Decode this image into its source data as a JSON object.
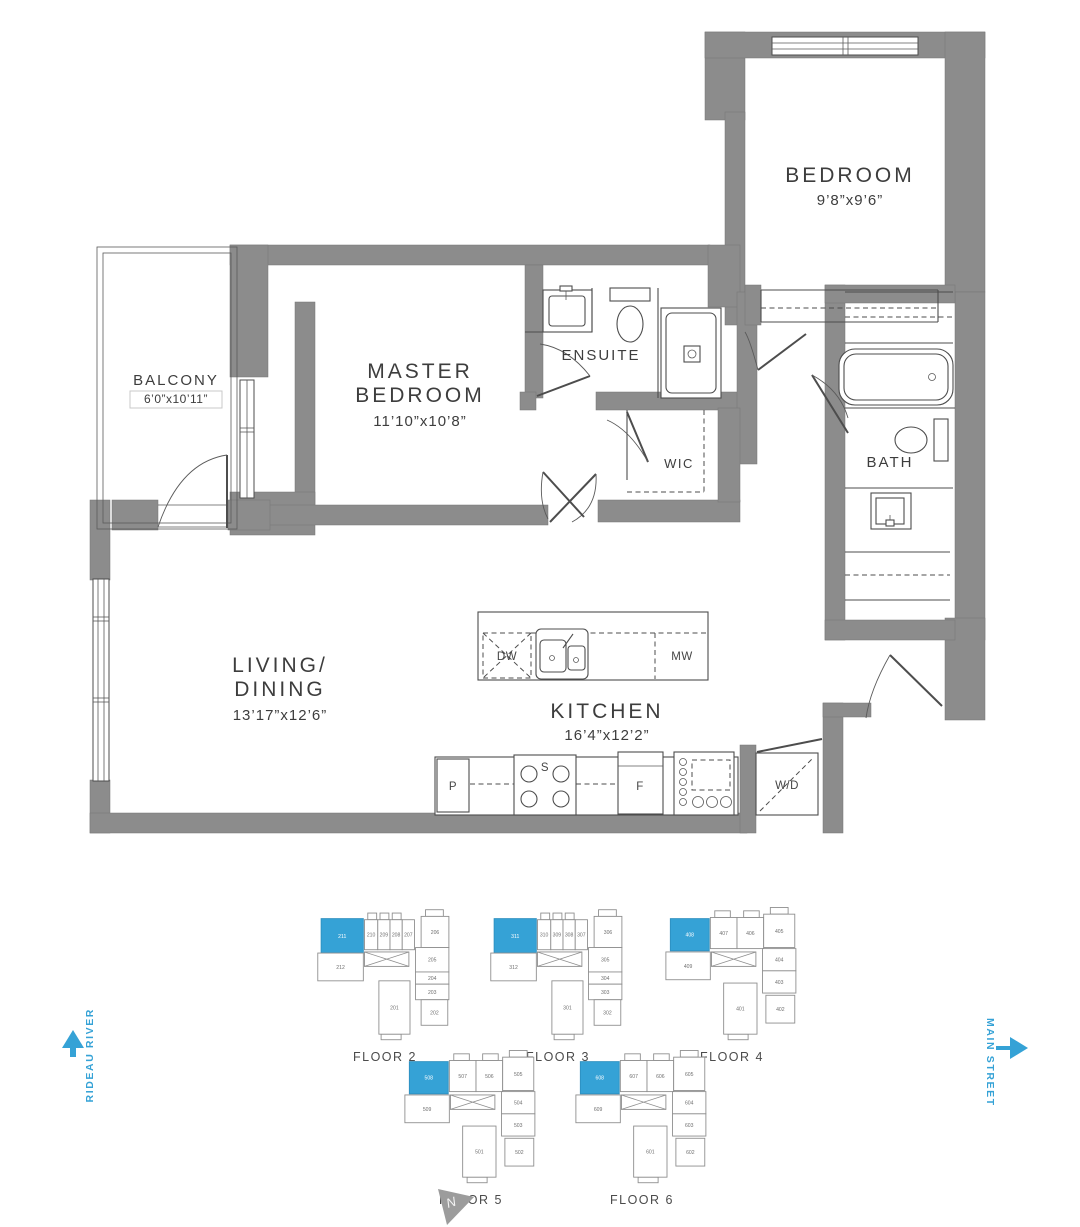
{
  "floorplan": {
    "rooms": {
      "bedroom": {
        "label": "BEDROOM",
        "dims": "9’8”x9’6”"
      },
      "master_bedroom": {
        "line1": "MASTER",
        "line2": "BEDROOM",
        "dims": "11’10”x10’8”"
      },
      "ensuite": {
        "label": "ENSUITE"
      },
      "wic": {
        "label": "WIC"
      },
      "bath": {
        "label": "BATH"
      },
      "balcony": {
        "label": "BALCONY",
        "dims": "6’0”x10’11”"
      },
      "living_dining": {
        "line1": "LIVING/",
        "line2": "DINING",
        "dims": "13’17”x12’6”"
      },
      "kitchen": {
        "label": "KITCHEN",
        "dims": "16’4”x12’2”"
      }
    },
    "appliances": {
      "dishwasher": "DW",
      "microwave": "MW",
      "pantry": "P",
      "stove": "S",
      "fridge": "F",
      "washer_dryer": "W/D"
    }
  },
  "keyplans": {
    "floors": [
      {
        "label": "FLOOR 2",
        "layout": "A",
        "highlighted": "211",
        "units": [
          "211",
          "210",
          "209",
          "208",
          "207",
          "206",
          "205",
          "204",
          "203",
          "202",
          "201",
          "212"
        ]
      },
      {
        "label": "FLOOR 3",
        "layout": "A",
        "highlighted": "311",
        "units": [
          "311",
          "310",
          "309",
          "308",
          "307",
          "306",
          "305",
          "304",
          "303",
          "302",
          "301",
          "312"
        ]
      },
      {
        "label": "FLOOR 4",
        "layout": "B",
        "highlighted": "408",
        "units": [
          "408",
          "407",
          "406",
          "405",
          "404",
          "403",
          "402",
          "401",
          "409"
        ]
      },
      {
        "label": "FLOOR 5",
        "layout": "B",
        "highlighted": "508",
        "units": [
          "508",
          "507",
          "506",
          "505",
          "504",
          "503",
          "502",
          "501",
          "509"
        ]
      },
      {
        "label": "FLOOR 6",
        "layout": "B",
        "highlighted": "608",
        "units": [
          "608",
          "607",
          "606",
          "605",
          "604",
          "603",
          "602",
          "601",
          "609"
        ]
      }
    ],
    "layouts": {
      "A": {
        "units": [
          {
            "x": 10,
            "y": 14,
            "w": 38,
            "h": 31
          },
          {
            "x": 49,
            "y": 15,
            "w": 12,
            "h": 27
          },
          {
            "x": 61,
            "y": 15,
            "w": 11,
            "h": 27
          },
          {
            "x": 72,
            "y": 15,
            "w": 11,
            "h": 27
          },
          {
            "x": 83,
            "y": 15,
            "w": 11,
            "h": 27
          },
          {
            "x": 100,
            "y": 12,
            "w": 25,
            "h": 28
          },
          {
            "x": 95,
            "y": 40,
            "w": 30,
            "h": 22
          },
          {
            "x": 95,
            "y": 62,
            "w": 30,
            "h": 11
          },
          {
            "x": 95,
            "y": 73,
            "w": 30,
            "h": 14
          },
          {
            "x": 100,
            "y": 87,
            "w": 24,
            "h": 23
          },
          {
            "x": 62,
            "y": 70,
            "w": 28,
            "h": 48
          },
          {
            "x": 7,
            "y": 45,
            "w": 41,
            "h": 25
          }
        ],
        "core": {
          "x": 49,
          "y": 44,
          "w": 40,
          "h": 13
        },
        "deco": [
          {
            "x": 52,
            "y": 9,
            "w": 8,
            "h": 6
          },
          {
            "x": 63,
            "y": 9,
            "w": 8,
            "h": 6
          },
          {
            "x": 74,
            "y": 9,
            "w": 8,
            "h": 6
          },
          {
            "x": 104,
            "y": 6,
            "w": 16,
            "h": 6
          },
          {
            "x": 64,
            "y": 118,
            "w": 18,
            "h": 5
          }
        ]
      },
      "B": {
        "units": [
          {
            "x": 12,
            "y": 14,
            "w": 35,
            "h": 29
          },
          {
            "x": 48,
            "y": 13,
            "w": 24,
            "h": 28
          },
          {
            "x": 72,
            "y": 13,
            "w": 24,
            "h": 28
          },
          {
            "x": 96,
            "y": 10,
            "w": 28,
            "h": 30
          },
          {
            "x": 95,
            "y": 41,
            "w": 30,
            "h": 20
          },
          {
            "x": 95,
            "y": 61,
            "w": 30,
            "h": 20
          },
          {
            "x": 98,
            "y": 83,
            "w": 26,
            "h": 25
          },
          {
            "x": 60,
            "y": 72,
            "w": 30,
            "h": 46
          },
          {
            "x": 8,
            "y": 44,
            "w": 40,
            "h": 25
          }
        ],
        "core": {
          "x": 49,
          "y": 44,
          "w": 40,
          "h": 13
        },
        "deco": [
          {
            "x": 52,
            "y": 7,
            "w": 14,
            "h": 6
          },
          {
            "x": 78,
            "y": 7,
            "w": 14,
            "h": 6
          },
          {
            "x": 102,
            "y": 4,
            "w": 16,
            "h": 6
          },
          {
            "x": 64,
            "y": 118,
            "w": 18,
            "h": 5
          }
        ]
      }
    }
  },
  "orientation": {
    "left_street": "RIDEAU RIVER",
    "right_street": "MAIN STREET",
    "compass_letter": "N"
  },
  "colors": {
    "wall": "#8c8c8c",
    "accent_blue": "#35a2d6",
    "line": "#4d4d4d"
  }
}
